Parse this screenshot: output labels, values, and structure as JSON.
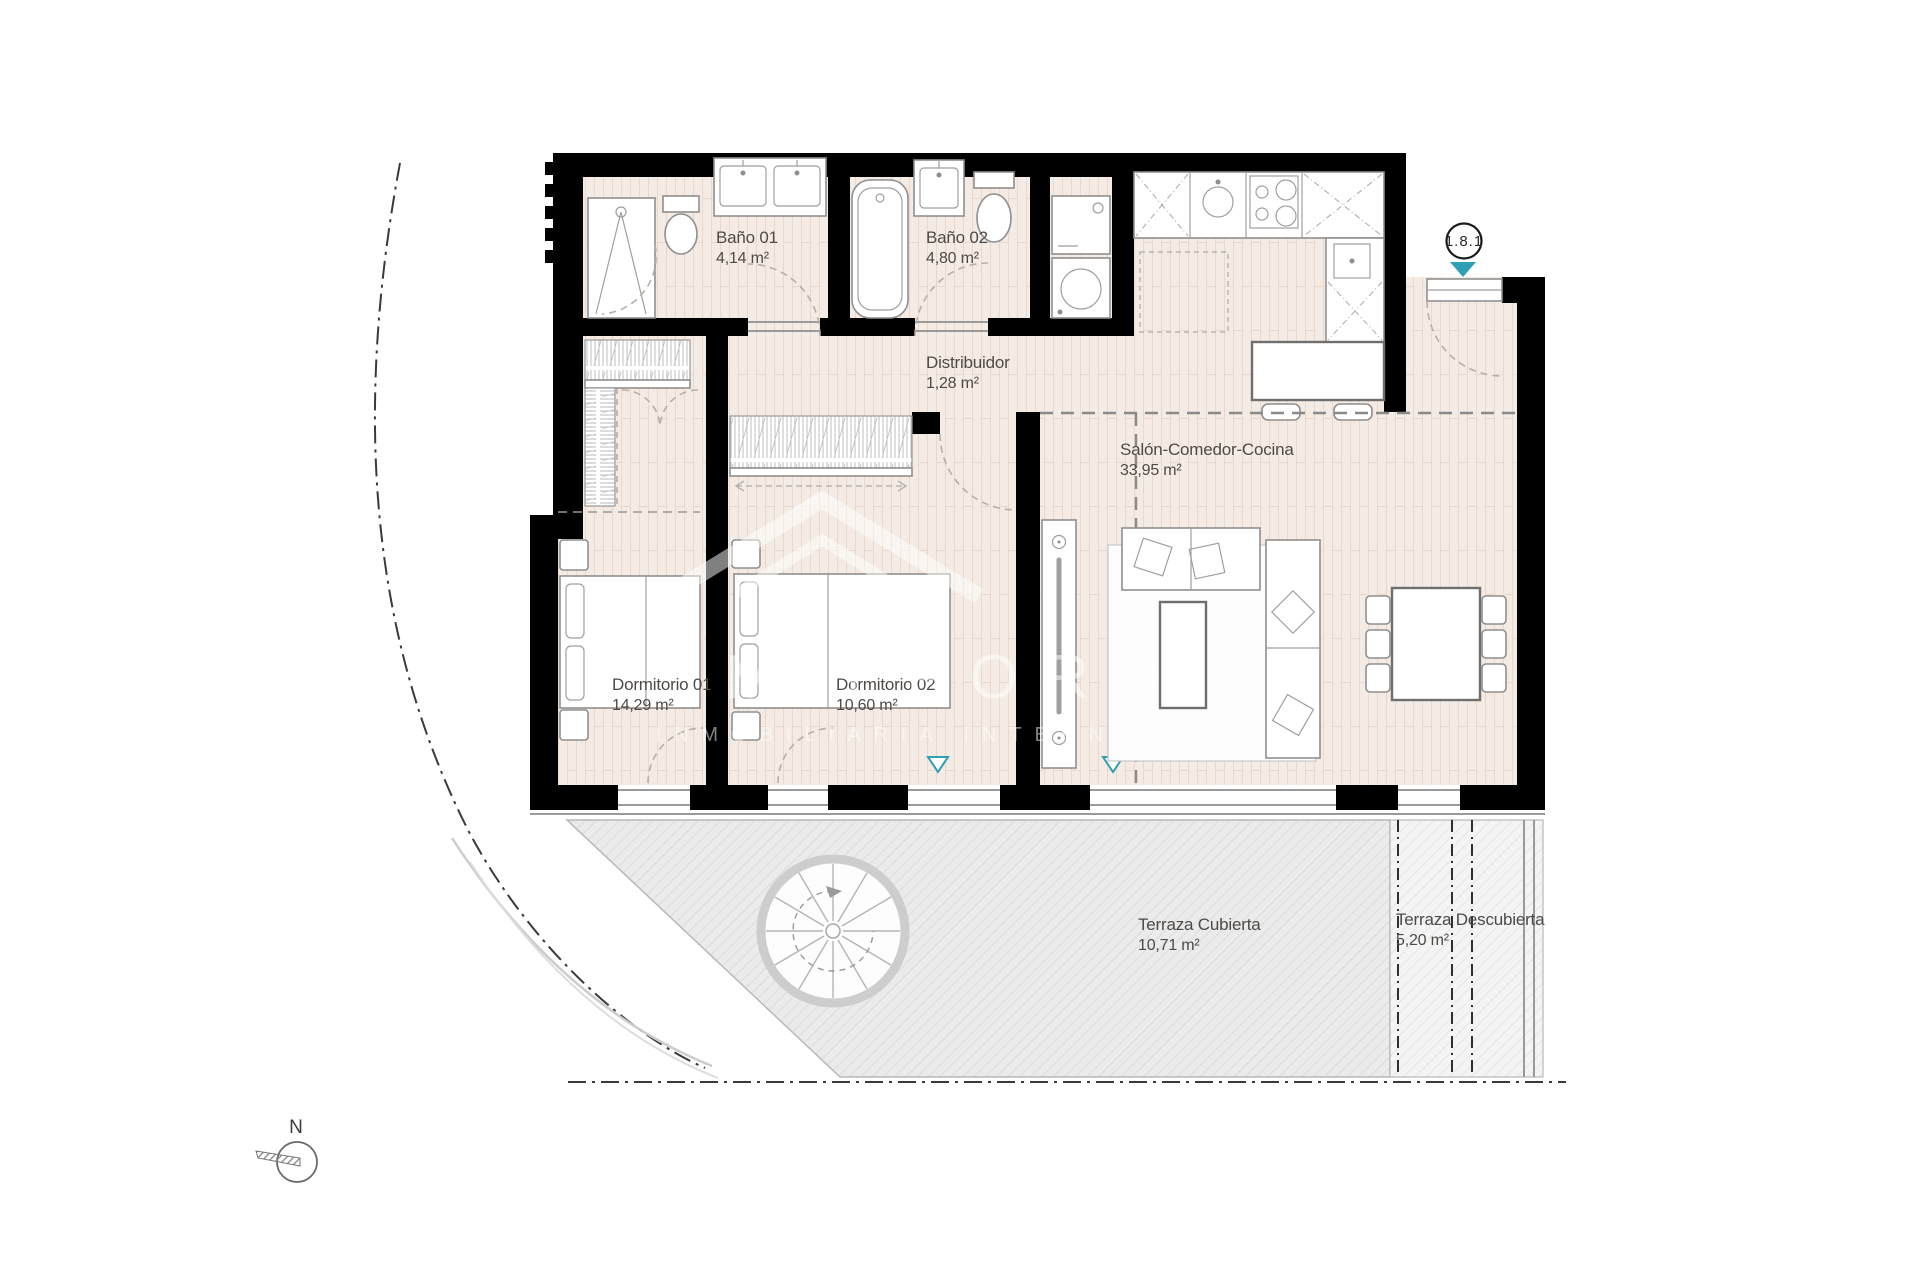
{
  "plan": {
    "unit_badge": "1.8.1",
    "compass_label": "N",
    "watermark": {
      "brand": "MILFORD",
      "subtitle": "INMOBILIARIA INTERNACIONAL"
    },
    "colors": {
      "wall": "#000000",
      "floor": "#f4ece4",
      "floor_line": "#e8d9cc",
      "terrace": "#ebebeb",
      "accent": "#2e9fb4",
      "label": "#4e4a47"
    },
    "rooms": [
      {
        "name": "Baño 01",
        "area": "4,14 m²"
      },
      {
        "name": "Baño 02",
        "area": "4,80 m²"
      },
      {
        "name": "Distribuidor",
        "area": "1,28 m²"
      },
      {
        "name": "Salón-Comedor-Cocina",
        "area": "33,95 m²"
      },
      {
        "name": "Dormitorio 01",
        "area": "14,29 m²"
      },
      {
        "name": "Dormitorio 02",
        "area": "10,60 m²"
      },
      {
        "name": "Terraza Cubierta",
        "area": "10,71 m²"
      },
      {
        "name": "Terraza Descubierta",
        "area": "5,20 m²"
      }
    ]
  }
}
